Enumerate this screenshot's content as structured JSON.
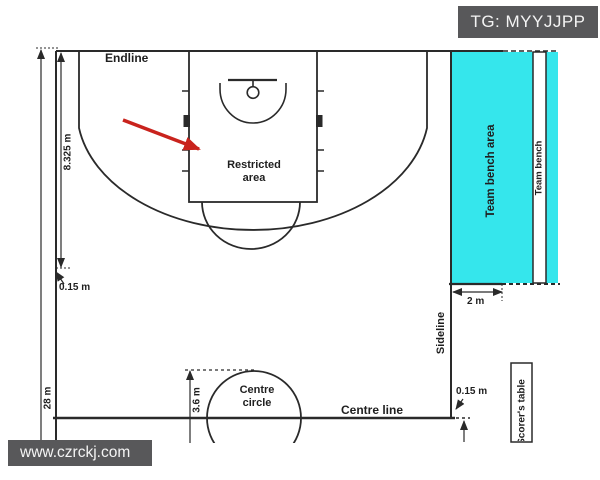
{
  "header": {
    "watermark_top": "TG: MYYJJPP"
  },
  "footer": {
    "watermark_bottom": "www.czrckj.com"
  },
  "diagram": {
    "labels": {
      "endline": "Endline",
      "restricted_area": "Restricted area",
      "centre_circle": "Centre circle",
      "centre_line": "Centre line",
      "sideline": "Sideline",
      "team_bench_area": "Team bench area",
      "team_bench": "Team bench",
      "scorers_table": "Scorer's table"
    },
    "dimensions": {
      "endline_to_arc": "8.325 m",
      "sideline_offset": "0.15 m",
      "court_length": "28 m",
      "circle_diameter": "3.6 m",
      "bench_offset": "2 m",
      "centreline_extension": "0.15 m"
    },
    "colors": {
      "bench_area_fill": "#35e6ec",
      "line": "#2a2a2a",
      "highlight_arrow": "#c9231d",
      "watermark_bg": "#58585a"
    }
  }
}
